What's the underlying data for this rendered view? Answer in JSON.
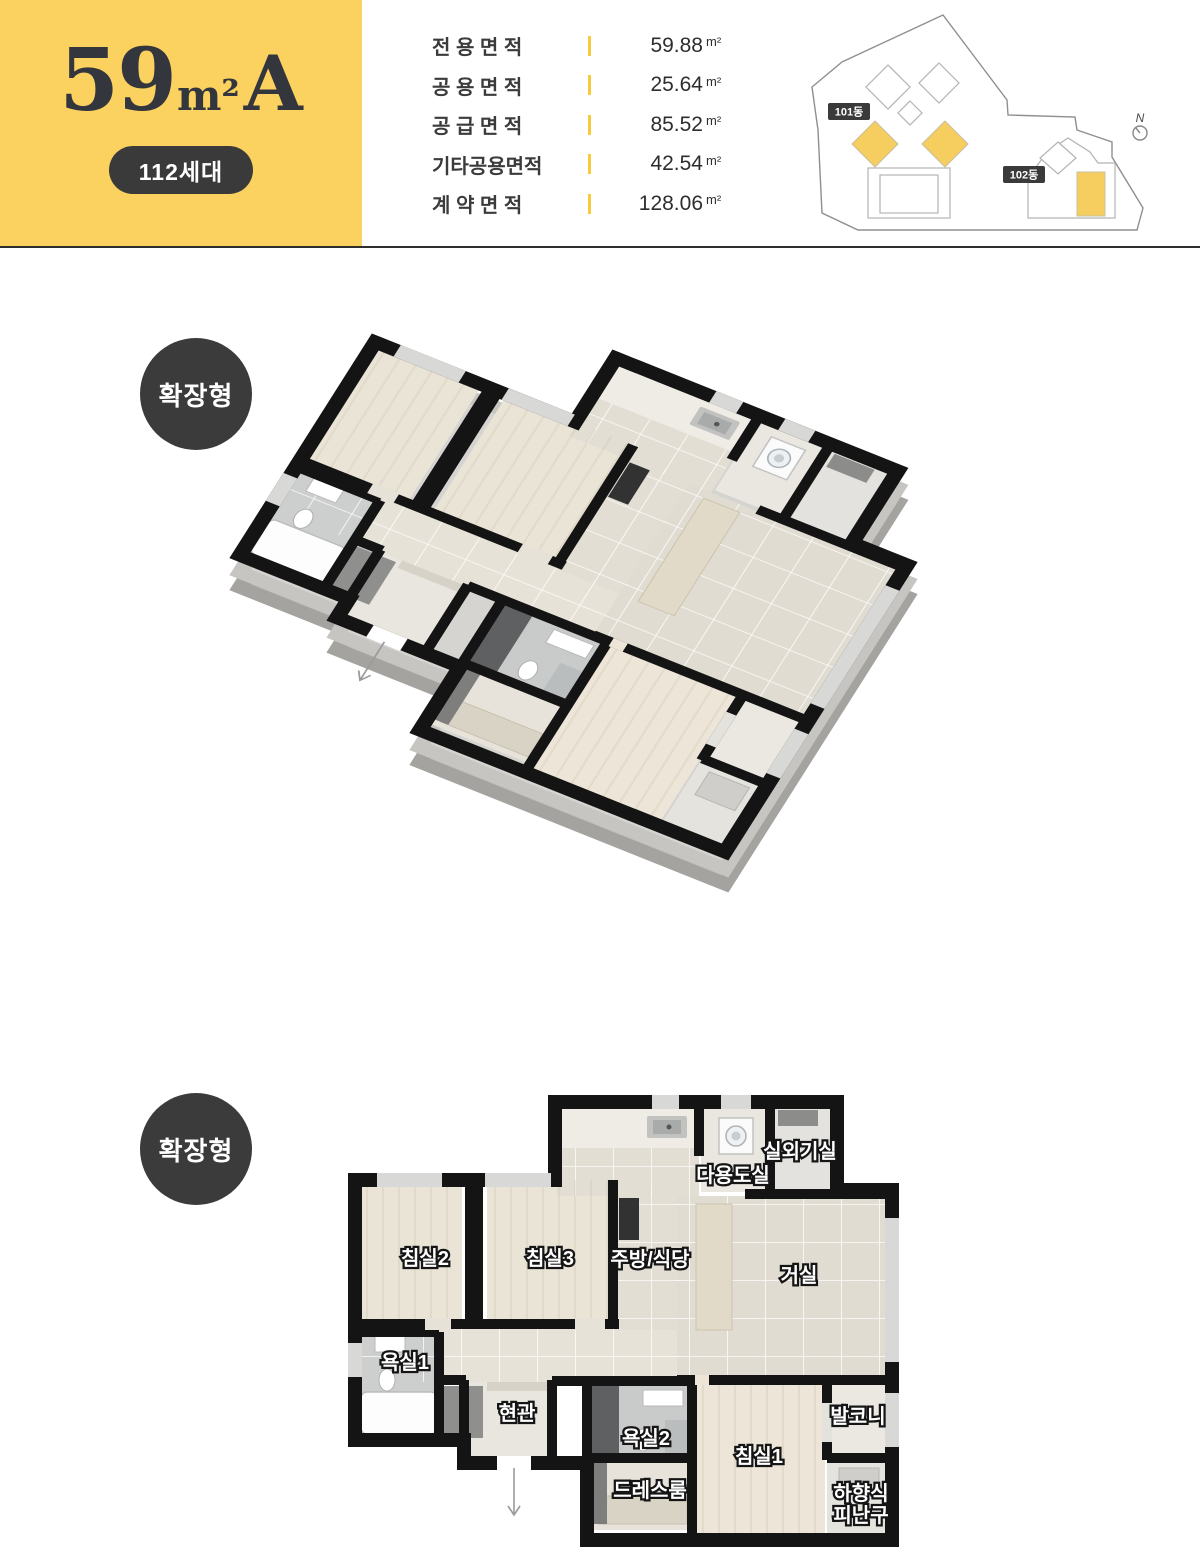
{
  "header": {
    "title": {
      "number": "59",
      "unit": "m²",
      "suffix": "A"
    },
    "households_badge": "112세대",
    "areas": [
      {
        "label": "전 용 면 적",
        "value": "59.88",
        "unit": "m²"
      },
      {
        "label": "공 용 면 적",
        "value": "25.64",
        "unit": "m²"
      },
      {
        "label": "공 급 면 적",
        "value": "85.52",
        "unit": "m²"
      },
      {
        "label": "기타공용면적",
        "value": "42.54",
        "unit": "m²"
      },
      {
        "label": "계 약 면 적",
        "value": "128.06",
        "unit": "m²"
      }
    ],
    "site_plan": {
      "building_101": "101동",
      "building_102": "102동",
      "north": "N",
      "highlight_color": "#F6CE5F"
    }
  },
  "iso_plan": {
    "badge": "확장형"
  },
  "plan_2d": {
    "badge": "확장형",
    "rooms": {
      "bedroom2": "침실2",
      "bedroom3": "침실3",
      "kitchen": "주방/식당",
      "living": "거실",
      "utility": "다용도실",
      "outdoor_unit": "실외기실",
      "bath1": "욕실1",
      "entrance": "현관",
      "bath2": "욕실2",
      "bedroom1": "침실1",
      "balcony": "발코니",
      "dressroom": "드레스룸",
      "escape_line1": "하향식",
      "escape_line2": "피난구"
    }
  },
  "colors": {
    "accent_yellow": "#FBD160",
    "badge_dark": "#3a3a3a",
    "wall_black": "#141414",
    "divider": "#2e2e2e",
    "tick_yellow": "#F7CA3F"
  }
}
